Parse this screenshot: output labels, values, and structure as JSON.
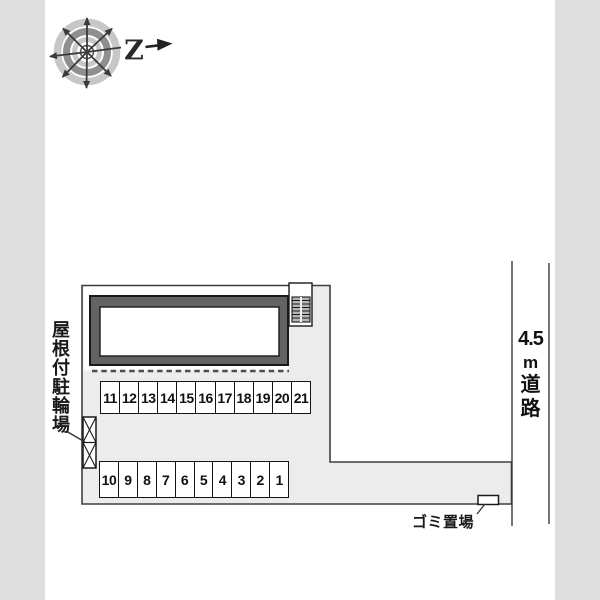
{
  "compass": {
    "north_label": "Z"
  },
  "icons": {
    "compass": "compass-rose",
    "north_arrow": "north-arrow"
  },
  "labels": {
    "bicycle_parking": "屋根付駐輪場",
    "garbage": "ゴミ置場"
  },
  "road": {
    "label_lines": [
      "4.5",
      "m",
      "道",
      "路"
    ]
  },
  "parking": {
    "upper_row": [
      "11",
      "12",
      "13",
      "14",
      "15",
      "16",
      "17",
      "18",
      "19",
      "20",
      "21"
    ],
    "lower_row": [
      "10",
      "9",
      "8",
      "7",
      "6",
      "5",
      "4",
      "3",
      "2",
      "1"
    ]
  },
  "colors": {
    "margin_band": "#dfdfdf",
    "site_fill": "#ececec",
    "building_frame": "#636363",
    "stairs_fill": "#b5b5b5",
    "line": "#3f3f3f"
  }
}
